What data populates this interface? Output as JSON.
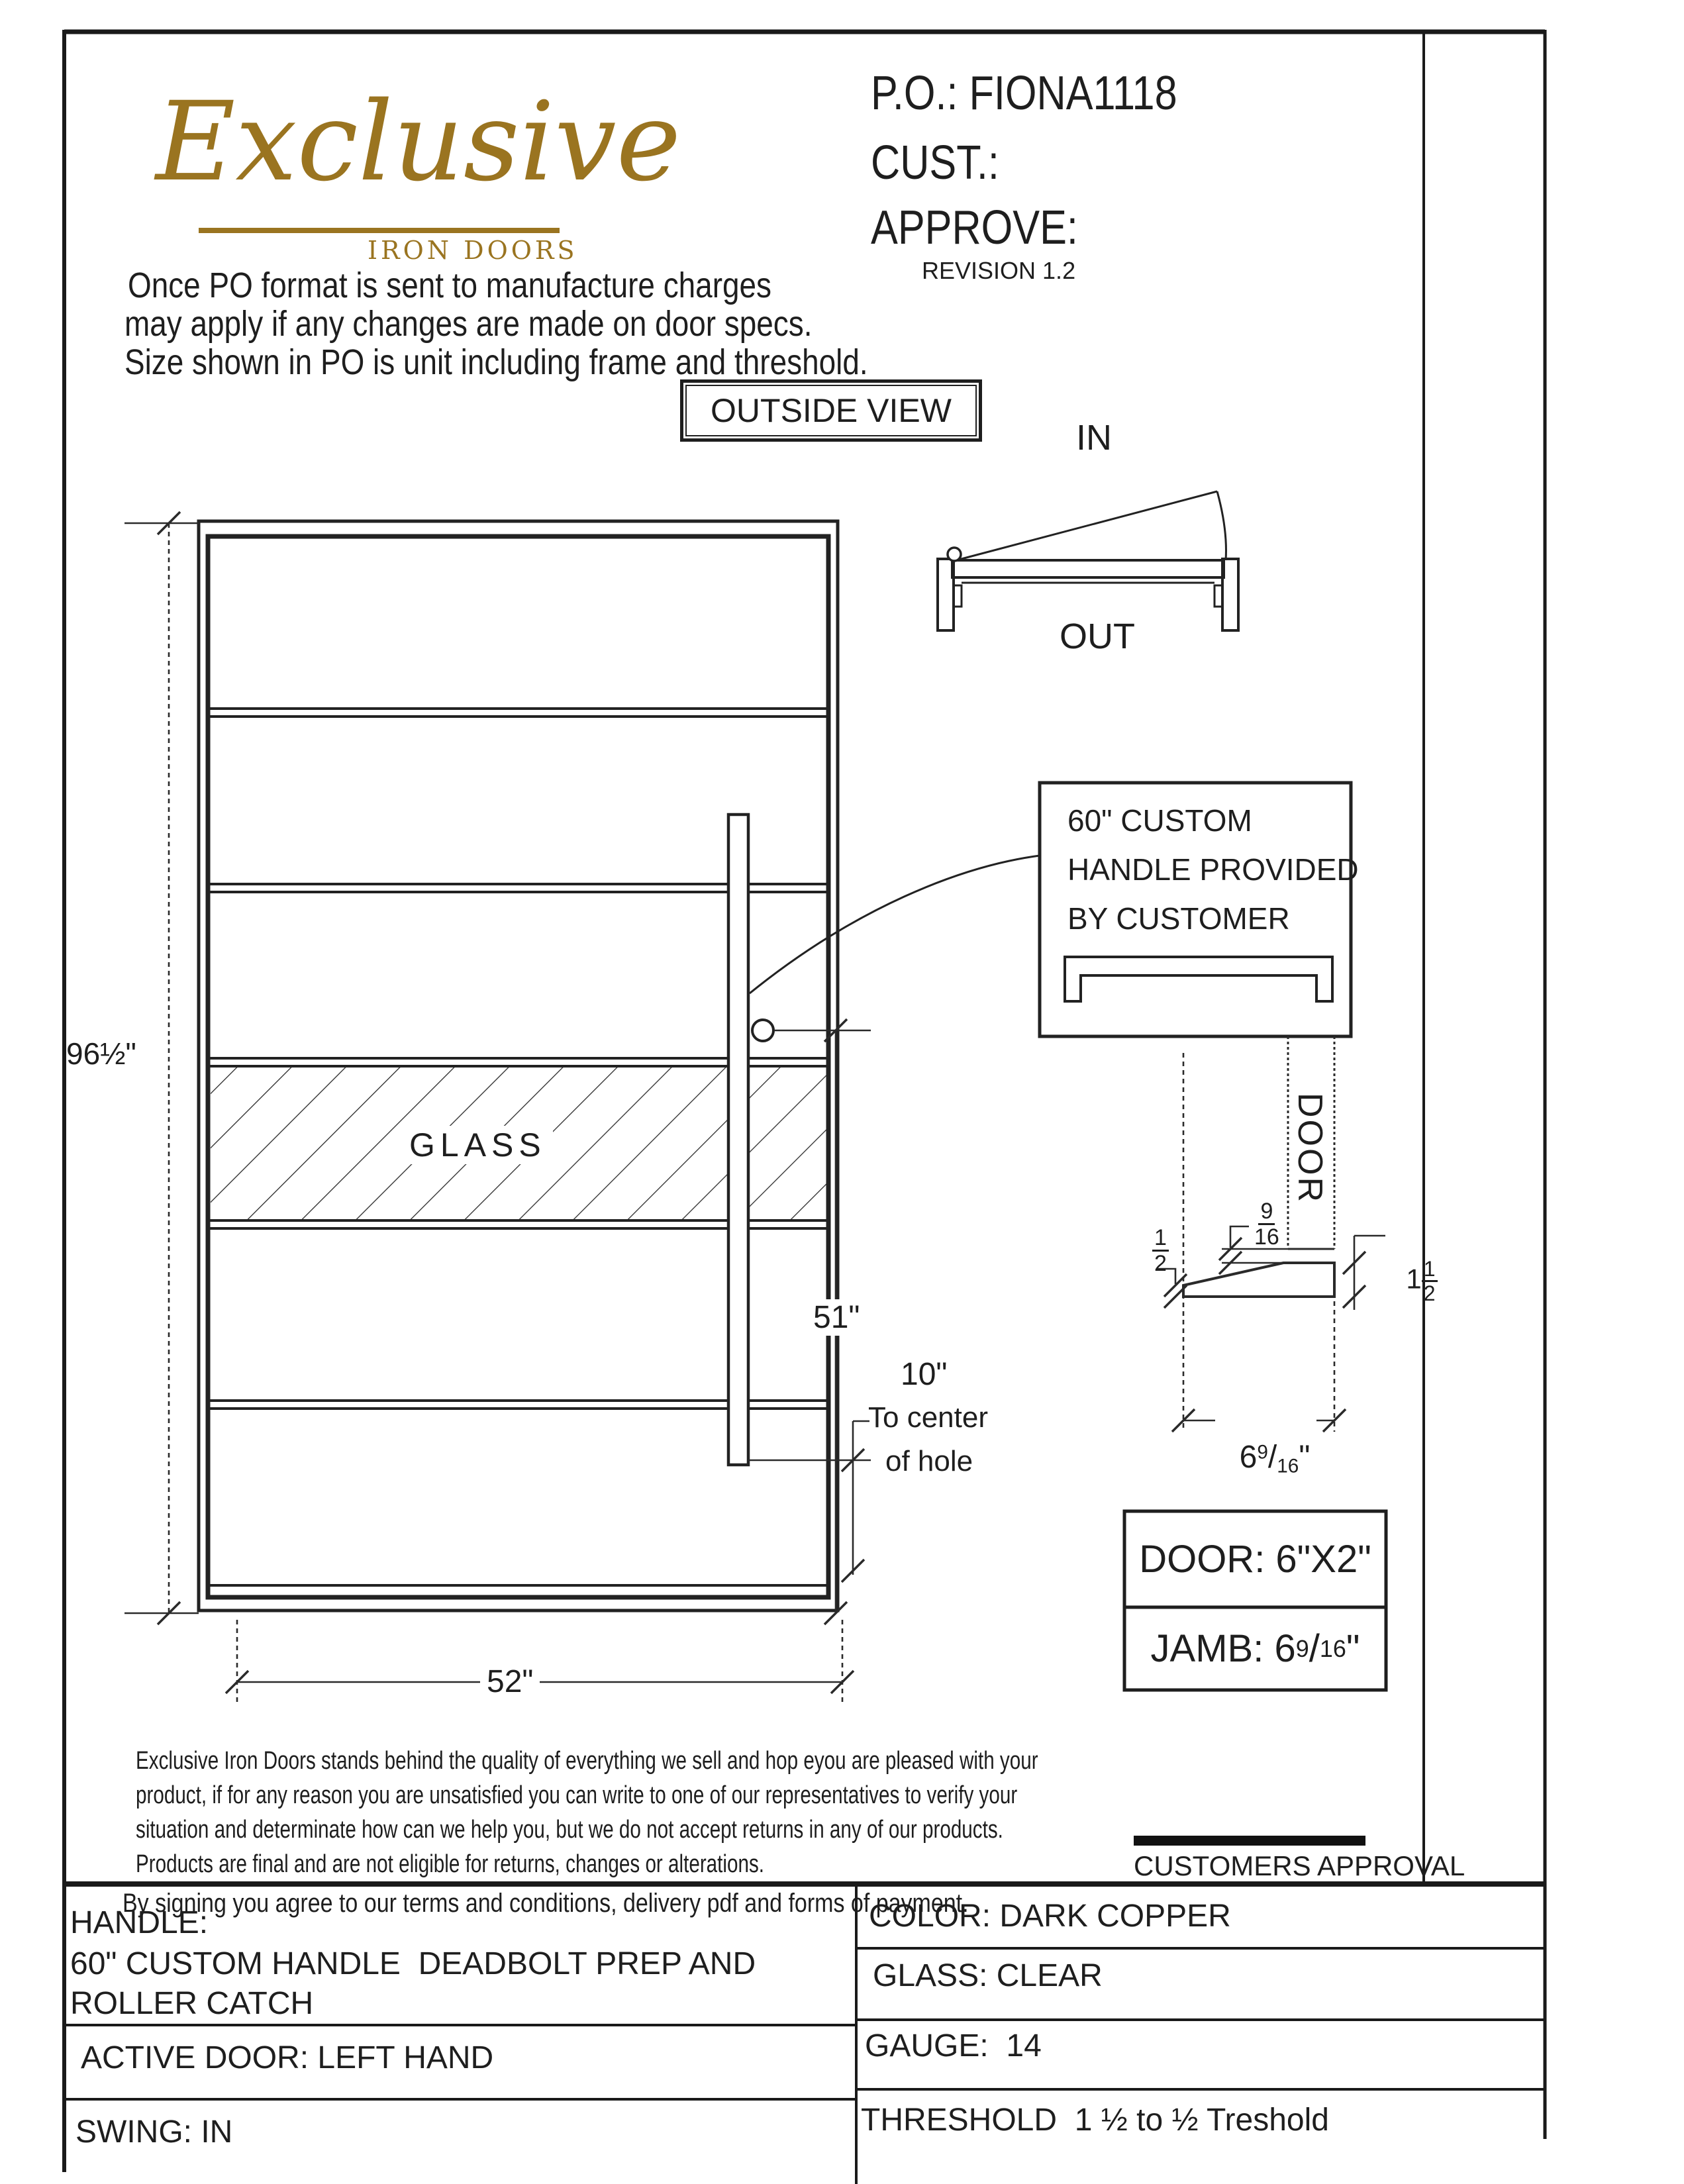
{
  "logo": {
    "name": "Exclusive",
    "tagline": "IRON DOORS"
  },
  "po_block": {
    "po": "P.O.: FIONA1118",
    "cust": "CUST.:",
    "approve": "APPROVE:",
    "revision": "REVISION 1.2"
  },
  "notes": [
    "Once PO format is sent to manufacture charges",
    "may apply if any changes are made on door specs.",
    "Size shown in PO is unit including frame and threshold."
  ],
  "view_label": "OUTSIDE VIEW",
  "swing_diagram": {
    "in_label": "IN",
    "out_label": "OUT"
  },
  "door_drawing": {
    "height_dim": "96½\"",
    "width_dim": "52\"",
    "handle_height_dim": "51\"",
    "hole_offset_dim": "10\"",
    "hole_note_line1": "To center",
    "hole_note_line2": "of hole",
    "glass_label": "GLASS"
  },
  "handle_callout": {
    "line1": "60\" CUSTOM",
    "line2": "HANDLE PROVIDED",
    "line3": "BY CUSTOMER"
  },
  "jamb_detail": {
    "door_label": "DOOR",
    "gap_num": "9",
    "gap_den": "16",
    "left_num": "1",
    "left_den": "2",
    "right_whole": "1",
    "right_num": "1",
    "right_den": "2",
    "width_whole": "6",
    "width_num": "9",
    "width_den": "16",
    "inch_mark": "\""
  },
  "spec_boxes": {
    "door": "DOOR: 6\"X2\"",
    "jamb_label": "JAMB: ",
    "jamb_whole": "6",
    "jamb_num": "9",
    "jamb_den": "16",
    "jamb_inch": "\""
  },
  "terms": {
    "line1": "Exclusive Iron Doors stands behind the quality of everything we sell and hop eyou are pleased with your",
    "line2": "product, if for any reason you are unsatisfied you can write to one of our representatives to verify your",
    "line3": "situation and determinate how can we help you, but we do not accept returns in any of our products.",
    "line4": "Products are final and are not eligible for returns, changes or alterations.",
    "signing": "By signing you agree to our terms and conditions, delivery pdf and forms of payment."
  },
  "approval": {
    "label": "CUSTOMERS APPROVAL"
  },
  "spec_table": {
    "left": [
      {
        "l1": "HANDLE:",
        "l2": "60\" CUSTOM HANDLE  DEADBOLT PREP AND",
        "l3": "ROLLER CATCH"
      },
      {
        "l1": "ACTIVE DOOR: LEFT HAND"
      },
      {
        "l1": "SWING: IN"
      }
    ],
    "right": [
      {
        "text": "COLOR: DARK COPPER"
      },
      {
        "text": "GLASS: CLEAR"
      },
      {
        "text": "GAUGE:  14"
      },
      {
        "text": "THRESHOLD  1 ½ to ½ Treshold"
      }
    ]
  },
  "colors": {
    "ink": "#1e1e1e",
    "logo_gold": "#9a7420",
    "paper": "#ffffff"
  }
}
